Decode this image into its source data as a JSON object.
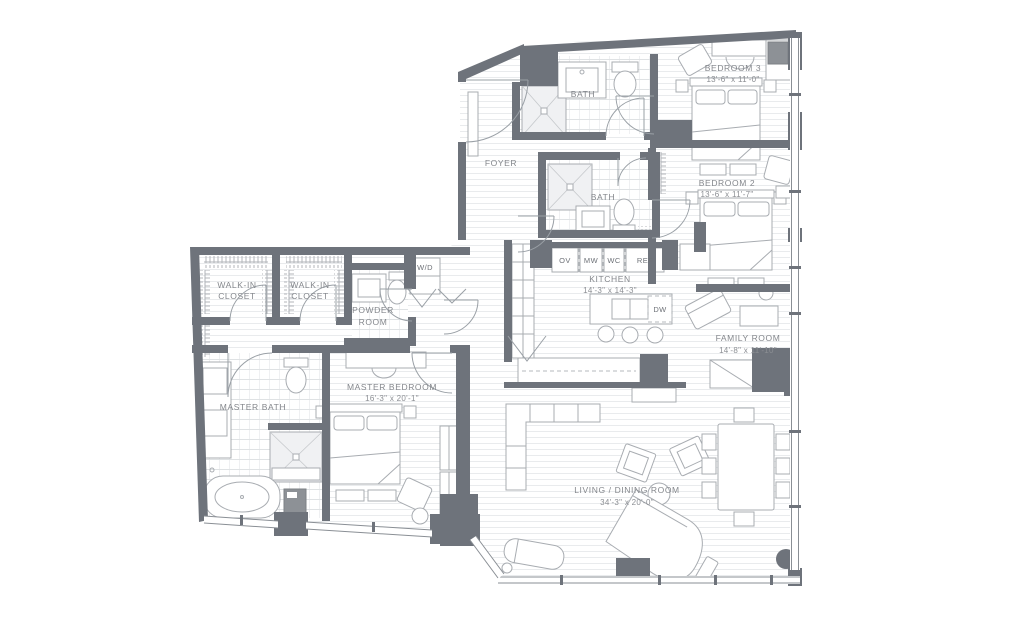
{
  "plan": {
    "title": "Residence floor plan",
    "colors": {
      "wall": "#6e737b",
      "furniture_line": "#a8acb1",
      "text": "#84878c",
      "floor_line": "#e9ebed",
      "tile_line": "#dfe2e4"
    },
    "rooms": {
      "bedroom3": {
        "name": "BEDROOM 3",
        "dims": "13'-6\" x 11'-0\""
      },
      "bedroom2": {
        "name": "BEDROOM 2",
        "dims": "13'-6\" x 11'-7\""
      },
      "bath_top": {
        "name": "BATH"
      },
      "bath_mid": {
        "name": "BATH"
      },
      "foyer": {
        "name": "FOYER"
      },
      "kitchen": {
        "name": "KITCHEN",
        "dims": "14'-3\" x 14'-3\""
      },
      "family_room": {
        "name": "FAMILY ROOM",
        "dims": "14'-8\" x 11'-10\""
      },
      "living_dining": {
        "name": "LIVING / DINING ROOM",
        "dims": "34'-3\" x 20'-0\""
      },
      "master_bedroom": {
        "name": "MASTER BEDROOM",
        "dims": "16'-3\" x 20'-1\""
      },
      "master_bath": {
        "name": "MASTER BATH"
      },
      "walk_in_closet_1": {
        "line1": "WALK-IN",
        "line2": "CLOSET"
      },
      "walk_in_closet_2": {
        "line1": "WALK-IN",
        "line2": "CLOSET"
      },
      "powder_room": {
        "line1": "POWDER",
        "line2": "ROOM"
      },
      "laundry": {
        "name": "W/D"
      }
    },
    "appliances": {
      "ov": "OV",
      "mw": "MW",
      "wc": "WC",
      "ref": "REF",
      "dw": "DW"
    }
  }
}
